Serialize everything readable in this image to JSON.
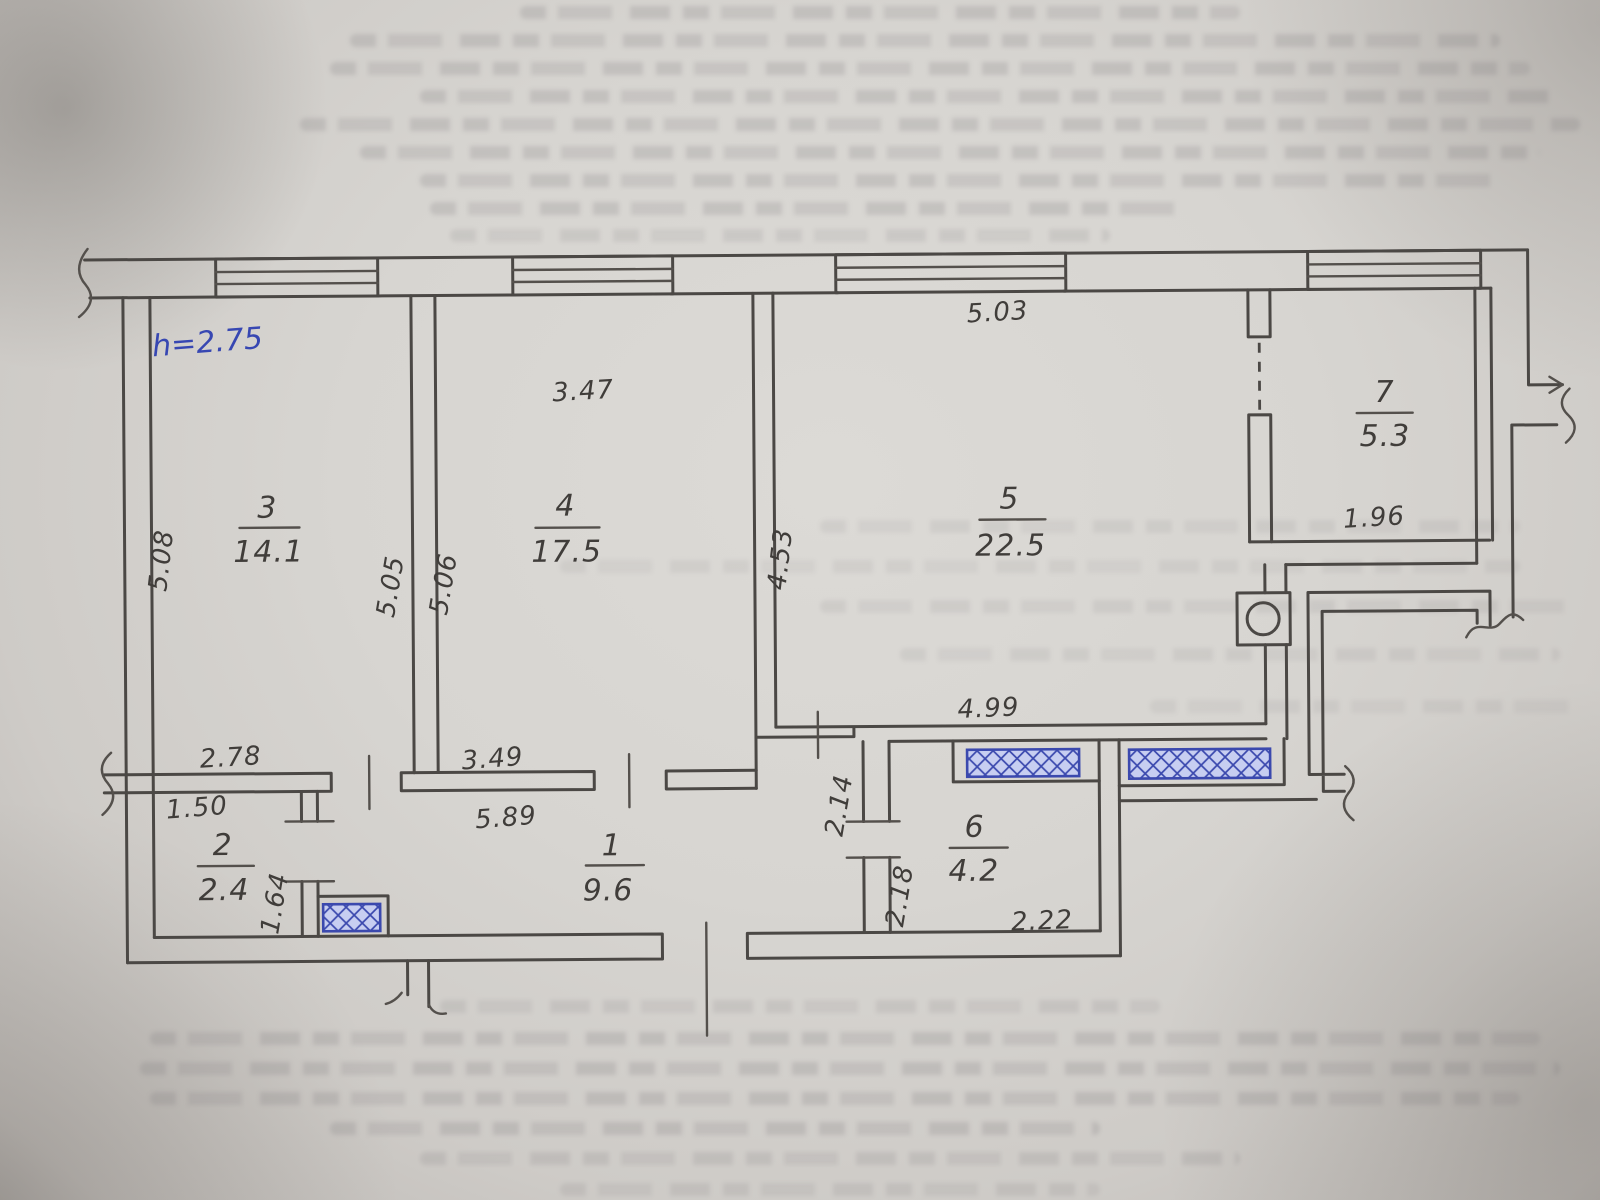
{
  "plan": {
    "height_note": "h=2.75",
    "rooms": {
      "r1": {
        "num": "1",
        "area": "9.6"
      },
      "r2": {
        "num": "2",
        "area": "2.4"
      },
      "r3": {
        "num": "3",
        "area": "14.1"
      },
      "r4": {
        "num": "4",
        "area": "17.5"
      },
      "r5": {
        "num": "5",
        "area": "22.5"
      },
      "r6": {
        "num": "6",
        "area": "4.2"
      },
      "r7": {
        "num": "7",
        "area": "5.3"
      }
    },
    "dims": {
      "r3_left": "5.08",
      "r3_right": "5.05",
      "r3_bottom": "2.78",
      "r4_top": "3.47",
      "r4_left": "5.06",
      "r4_bottom": "3.49",
      "r5_top": "5.03",
      "r5_left": "4.53",
      "r5_inner": "4.99",
      "r7_width": "1.96",
      "hall_upper": "2.14",
      "hall_lower": "2.18",
      "r6_bottom": "2.22",
      "r2_top": "1.50",
      "r2_right": "1.64",
      "r1_top": "5.89"
    }
  }
}
